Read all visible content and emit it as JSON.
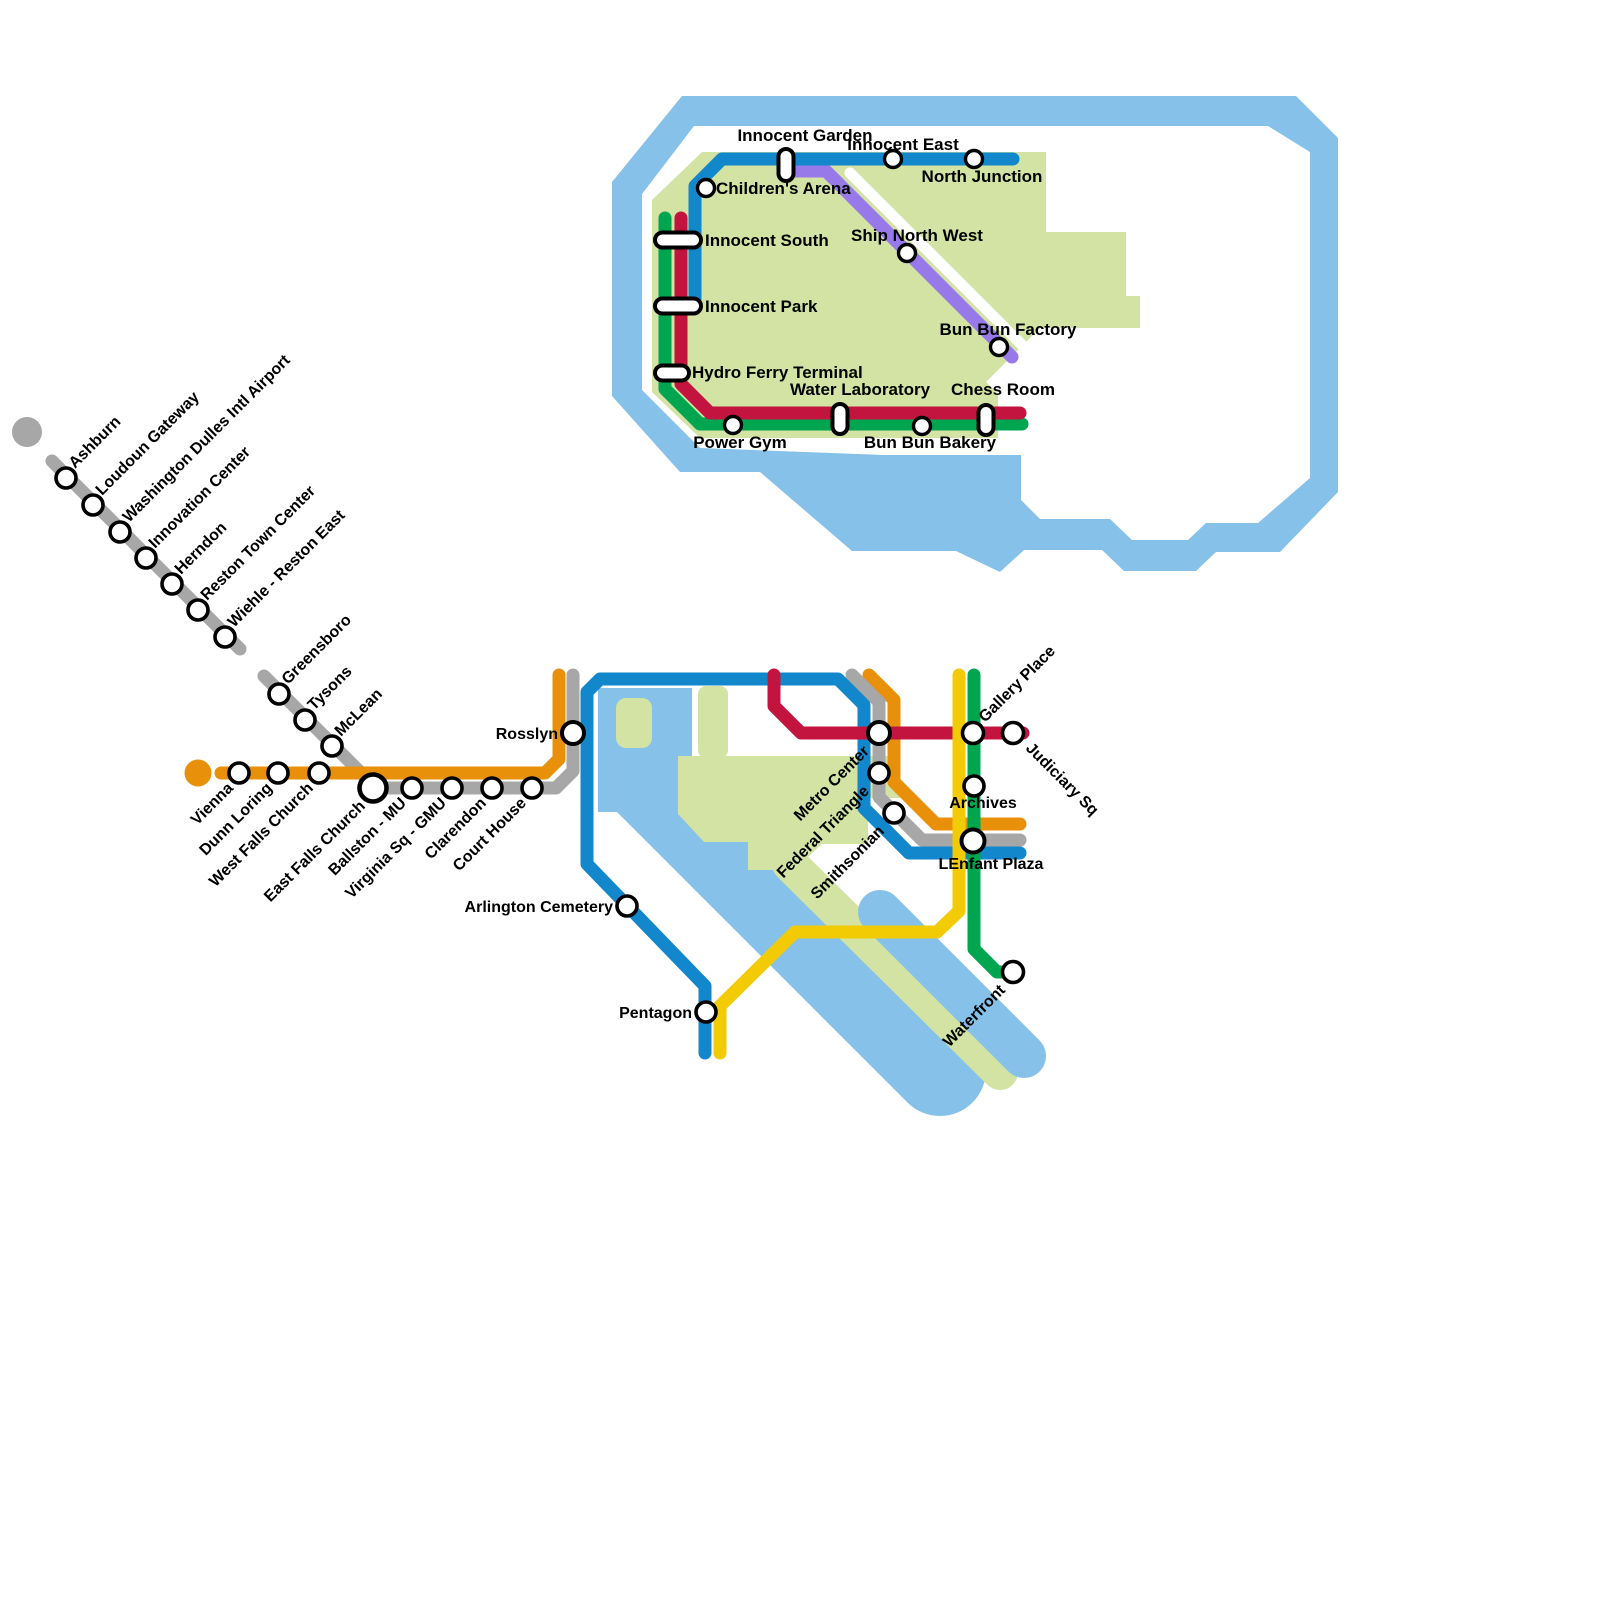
{
  "canvas": {
    "width": 1600,
    "height": 1600
  },
  "palette": {
    "water": "#85C1E8",
    "land": "#D2E3A4",
    "white": "#FFFFFF",
    "blue": "#1287CC",
    "red": "#C31440",
    "green": "#00A550",
    "orange": "#E8900A",
    "silver": "#A7A7A7",
    "yellow": "#F2CB05",
    "purple": "#9879E9",
    "station_fill": "#FFFFFF",
    "station_stroke": "#000000"
  },
  "shapes": [
    {
      "id": "island-water-ring",
      "type": "path",
      "fill": "water",
      "fillRule": "evenodd",
      "d": "M 612,396 L 612,182 L 682,96 L 1296,96 L 1338,138 L 1338,492 L 1280,552 L 1216,552 L 1196,571 L 1124,571 L 1102,550 L 1024,550 L 1000,572 L 956,551 L 852,551 L 760,472 L 680,472 Z M 642,390 L 642,194 L 694,126 L 1268,126 L 1310,152 L 1310,478 L 1258,523 L 1206,523 L 1188,540 L 1132,540 L 1110,519 L 1040,519 L 1021,500 L 1021,455 L 884,455 L 700,448 L 642,390 Z"
    },
    {
      "id": "island-land",
      "type": "path",
      "fill": "land",
      "d": "M 702,152 L 1046,152 L 1046,232 L 1126,232 L 1126,296 L 1140,296 L 1140,328 L 1040,328 L 986,382 L 998,394 L 998,438 L 700,438 L 652,392 L 652,200 Z"
    },
    {
      "id": "island-white-stripe",
      "type": "stroke",
      "color": "white",
      "width": 11,
      "points": [
        [
          850,
          173
        ],
        [
          1036,
          359
        ]
      ]
    },
    {
      "id": "potomac-river-column",
      "type": "path",
      "fill": "water",
      "d": "M 598,688 L 692,688 L 692,812 L 598,812 Z"
    },
    {
      "id": "potomac-river-band",
      "type": "stroke",
      "color": "water",
      "width": 92,
      "points": [
        [
          650,
          780
        ],
        [
          940,
          1070
        ]
      ]
    },
    {
      "id": "roosevelt-island",
      "type": "rect",
      "fill": "land",
      "x": 616,
      "y": 698,
      "w": 36,
      "h": 50,
      "r": 10
    },
    {
      "id": "mall-land-column",
      "type": "rect",
      "fill": "land",
      "x": 698,
      "y": 686,
      "w": 30,
      "h": 72,
      "r": 8
    },
    {
      "id": "mall-land-blob",
      "type": "path",
      "fill": "land",
      "d": "M 678,756 L 900,756 L 900,798 L 868,798 L 868,844 L 822,844 L 794,870 L 748,870 L 748,842 L 704,842 L 678,814 Z"
    },
    {
      "id": "hains-point-strip",
      "type": "stroke",
      "color": "land",
      "width": 36,
      "points": [
        [
          790,
          864
        ],
        [
          1000,
          1072
        ]
      ]
    },
    {
      "id": "anacostia-river-band",
      "type": "stroke",
      "color": "water",
      "width": 44,
      "points": [
        [
          880,
          912
        ],
        [
          1024,
          1056
        ]
      ]
    }
  ],
  "terminal_dots": [
    {
      "id": "silver-line-terminal-dot",
      "x": 27,
      "y": 432,
      "r": 15,
      "color": "silver"
    },
    {
      "id": "orange-line-terminal-dot",
      "x": 198,
      "y": 773,
      "r": 13.5,
      "color": "orange"
    }
  ],
  "lines": [
    {
      "id": "inset-purple-line",
      "color": "purple",
      "width": 13,
      "points": [
        [
          795,
          171
        ],
        [
          826,
          171
        ],
        [
          1012,
          357
        ]
      ]
    },
    {
      "id": "inset-blue-line",
      "color": "blue",
      "width": 13,
      "points": [
        [
          1013,
          159
        ],
        [
          722,
          159
        ],
        [
          695,
          186
        ],
        [
          695,
          307
        ]
      ]
    },
    {
      "id": "inset-green-line",
      "color": "green",
      "width": 13,
      "points": [
        [
          665,
          218
        ],
        [
          665,
          389
        ],
        [
          700,
          424
        ],
        [
          1022,
          424
        ]
      ]
    },
    {
      "id": "inset-red-line",
      "color": "red",
      "width": 13,
      "points": [
        [
          681,
          218
        ],
        [
          681,
          384
        ],
        [
          710,
          413
        ],
        [
          1020,
          413
        ]
      ]
    },
    {
      "id": "silver-line-northwest-branch",
      "color": "silver",
      "width": 13,
      "points": [
        [
          52,
          461
        ],
        [
          240,
          649
        ]
      ]
    },
    {
      "id": "silver-line-tysons-branch",
      "color": "silver",
      "width": 13,
      "points": [
        [
          264,
          676
        ],
        [
          376,
          788
        ],
        [
          556,
          788
        ],
        [
          573,
          771
        ],
        [
          573,
          675
        ]
      ]
    },
    {
      "id": "orange-line-west",
      "color": "orange",
      "width": 13,
      "points": [
        [
          221,
          773
        ],
        [
          545,
          773
        ],
        [
          559,
          759
        ],
        [
          559,
          675
        ]
      ]
    },
    {
      "id": "orange-line-downtown",
      "color": "orange",
      "width": 13,
      "points": [
        [
          869,
          675
        ],
        [
          894,
          700
        ],
        [
          894,
          782
        ],
        [
          936,
          824
        ],
        [
          1020,
          824
        ]
      ]
    },
    {
      "id": "silver-line-downtown",
      "color": "silver",
      "width": 13,
      "points": [
        [
          852,
          675
        ],
        [
          879,
          702
        ],
        [
          879,
          797
        ],
        [
          922,
          840
        ],
        [
          1020,
          840
        ]
      ]
    },
    {
      "id": "blue-line",
      "color": "blue",
      "width": 13,
      "points": [
        [
          705,
          1053
        ],
        [
          705,
          986
        ],
        [
          587,
          864
        ],
        [
          587,
          692
        ],
        [
          600,
          679
        ],
        [
          838,
          679
        ],
        [
          864,
          705
        ],
        [
          864,
          808
        ],
        [
          909,
          853
        ],
        [
          1020,
          853
        ]
      ]
    },
    {
      "id": "red-line",
      "color": "red",
      "width": 13,
      "points": [
        [
          774,
          675
        ],
        [
          774,
          706
        ],
        [
          801,
          733
        ],
        [
          1023,
          733
        ]
      ]
    },
    {
      "id": "yellow-line",
      "color": "yellow",
      "width": 13,
      "points": [
        [
          959,
          675
        ],
        [
          959,
          911
        ],
        [
          937,
          932
        ],
        [
          795,
          932
        ],
        [
          720,
          1006
        ],
        [
          720,
          1053
        ]
      ]
    },
    {
      "id": "green-line",
      "color": "green",
      "width": 13,
      "points": [
        [
          974,
          675
        ],
        [
          974,
          949
        ],
        [
          997,
          972
        ],
        [
          1018,
          972
        ]
      ]
    }
  ],
  "inset_stations": [
    {
      "name": "Innocent Garden",
      "x": 786,
      "y": 165,
      "marker": "pill-v",
      "w": 15,
      "h": 32,
      "label": {
        "dx": 19,
        "dy": -24,
        "anchor": "middle",
        "rot": 0
      }
    },
    {
      "name": "Innocent East",
      "x": 893,
      "y": 159,
      "marker": "circle",
      "r": 8.5,
      "label": {
        "dx": 10,
        "dy": -9,
        "anchor": "middle",
        "rot": 0
      }
    },
    {
      "name": "North Junction",
      "x": 974,
      "y": 159,
      "marker": "circle",
      "r": 8.5,
      "label": {
        "dx": 8,
        "dy": 23,
        "anchor": "middle",
        "rot": 0
      }
    },
    {
      "name": "Children's Arena",
      "x": 706,
      "y": 188,
      "marker": "circle",
      "r": 8.5,
      "label": {
        "dx": 10,
        "dy": 6,
        "anchor": "start",
        "rot": 0
      }
    },
    {
      "name": "Innocent South",
      "x": 678,
      "y": 240,
      "marker": "pill-h",
      "w": 46,
      "h": 15,
      "label": {
        "dx": 27,
        "dy": 6,
        "anchor": "start",
        "rot": 0
      }
    },
    {
      "name": "Innocent Park",
      "x": 678,
      "y": 306,
      "marker": "pill-h",
      "w": 46,
      "h": 15,
      "label": {
        "dx": 27,
        "dy": 6,
        "anchor": "start",
        "rot": 0
      }
    },
    {
      "name": "Hydro Ferry Terminal",
      "x": 672,
      "y": 373,
      "marker": "pill-h",
      "w": 34,
      "h": 15,
      "label": {
        "dx": 20,
        "dy": 5,
        "anchor": "start",
        "rot": 0
      }
    },
    {
      "name": "Ship North West",
      "x": 907,
      "y": 253,
      "marker": "circle",
      "r": 8.5,
      "label": {
        "dx": 10,
        "dy": -12,
        "anchor": "middle",
        "rot": 0
      }
    },
    {
      "name": "Bun Bun Factory",
      "x": 999,
      "y": 347,
      "marker": "circle",
      "r": 8.5,
      "label": {
        "dx": 9,
        "dy": -12,
        "anchor": "middle",
        "rot": 0
      }
    },
    {
      "name": "Water Laboratory",
      "x": 840,
      "y": 419,
      "marker": "pill-v",
      "w": 15,
      "h": 30,
      "label": {
        "dx": 20,
        "dy": -24,
        "anchor": "middle",
        "rot": 0
      }
    },
    {
      "name": "Chess Room",
      "x": 986,
      "y": 420,
      "marker": "pill-v",
      "w": 15,
      "h": 30,
      "label": {
        "dx": 17,
        "dy": -25,
        "anchor": "middle",
        "rot": 0
      }
    },
    {
      "name": "Power Gym",
      "x": 733,
      "y": 425,
      "marker": "circle",
      "r": 8.5,
      "label": {
        "dx": 7,
        "dy": 23,
        "anchor": "middle",
        "rot": 0
      }
    },
    {
      "name": "Bun Bun Bakery",
      "x": 922,
      "y": 426,
      "marker": "circle",
      "r": 8.5,
      "label": {
        "dx": 8,
        "dy": 22,
        "anchor": "middle",
        "rot": 0
      }
    }
  ],
  "main_stations": [
    {
      "name": "Ashburn",
      "x": 66,
      "y": 478,
      "marker": "circle",
      "r": 10,
      "label": {
        "dx": 9,
        "dy": -9,
        "anchor": "start",
        "rot": -45
      }
    },
    {
      "name": "Loudoun Gateway",
      "x": 93,
      "y": 505,
      "marker": "circle",
      "r": 10,
      "label": {
        "dx": 9,
        "dy": -9,
        "anchor": "start",
        "rot": -45
      }
    },
    {
      "name": "Washington Dulles Intl Airport",
      "x": 120,
      "y": 532,
      "marker": "circle",
      "r": 10,
      "label": {
        "dx": 9,
        "dy": -9,
        "anchor": "start",
        "rot": -45
      }
    },
    {
      "name": "Innovation Center",
      "x": 146,
      "y": 558,
      "marker": "circle",
      "r": 10,
      "label": {
        "dx": 9,
        "dy": -9,
        "anchor": "start",
        "rot": -45
      }
    },
    {
      "name": "Herndon",
      "x": 172,
      "y": 584,
      "marker": "circle",
      "r": 10,
      "label": {
        "dx": 9,
        "dy": -9,
        "anchor": "start",
        "rot": -45
      }
    },
    {
      "name": "Reston Town Center",
      "x": 198,
      "y": 610,
      "marker": "circle",
      "r": 10,
      "label": {
        "dx": 9,
        "dy": -9,
        "anchor": "start",
        "rot": -45
      }
    },
    {
      "name": "Wiehle - Reston East",
      "x": 225,
      "y": 637,
      "marker": "circle",
      "r": 10,
      "label": {
        "dx": 9,
        "dy": -9,
        "anchor": "start",
        "rot": -45
      }
    },
    {
      "name": "Greensboro",
      "x": 279,
      "y": 694,
      "marker": "circle",
      "r": 10,
      "label": {
        "dx": 9,
        "dy": -9,
        "anchor": "start",
        "rot": -45
      }
    },
    {
      "name": "Tysons",
      "x": 305,
      "y": 720,
      "marker": "circle",
      "r": 10,
      "label": {
        "dx": 9,
        "dy": -9,
        "anchor": "start",
        "rot": -45
      }
    },
    {
      "name": "McLean",
      "x": 332,
      "y": 746,
      "marker": "circle",
      "r": 10,
      "label": {
        "dx": 9,
        "dy": -9,
        "anchor": "start",
        "rot": -45
      }
    },
    {
      "name": "Vienna",
      "x": 239,
      "y": 773,
      "marker": "circle",
      "r": 10,
      "label": {
        "dx": -5,
        "dy": 16,
        "anchor": "end",
        "rot": -45
      }
    },
    {
      "name": "Dunn Loring",
      "x": 278,
      "y": 773,
      "marker": "circle",
      "r": 10,
      "label": {
        "dx": -5,
        "dy": 16,
        "anchor": "end",
        "rot": -45
      }
    },
    {
      "name": "West Falls Church",
      "x": 319,
      "y": 773,
      "marker": "circle",
      "r": 10,
      "label": {
        "dx": -5,
        "dy": 16,
        "anchor": "end",
        "rot": -45
      }
    },
    {
      "name": "East Falls Church",
      "x": 373,
      "y": 788,
      "marker": "circle",
      "r": 13.5,
      "sw": 4.6,
      "label": {
        "dx": -7,
        "dy": 19,
        "anchor": "end",
        "rot": -45
      }
    },
    {
      "name": "Ballston - MU",
      "x": 412,
      "y": 788,
      "marker": "circle",
      "r": 10,
      "label": {
        "dx": -5,
        "dy": 16,
        "anchor": "end",
        "rot": -45
      }
    },
    {
      "name": "Virginia Sq - GMU",
      "x": 452,
      "y": 788,
      "marker": "circle",
      "r": 10,
      "label": {
        "dx": -5,
        "dy": 16,
        "anchor": "end",
        "rot": -45
      }
    },
    {
      "name": "Clarendon",
      "x": 492,
      "y": 788,
      "marker": "circle",
      "r": 10,
      "label": {
        "dx": -5,
        "dy": 16,
        "anchor": "end",
        "rot": -45
      }
    },
    {
      "name": "Court House",
      "x": 532,
      "y": 788,
      "marker": "circle",
      "r": 10,
      "label": {
        "dx": -5,
        "dy": 16,
        "anchor": "end",
        "rot": -45
      }
    },
    {
      "name": "Rosslyn",
      "x": 573,
      "y": 733,
      "marker": "circle",
      "r": 11,
      "sw": 4,
      "label": {
        "dx": -15,
        "dy": 6,
        "anchor": "end",
        "rot": 0
      }
    },
    {
      "name": "Arlington Cemetery",
      "x": 627,
      "y": 906,
      "marker": "circle",
      "r": 10,
      "label": {
        "dx": -14,
        "dy": 6,
        "anchor": "end",
        "rot": 0
      }
    },
    {
      "name": "Pentagon",
      "x": 706,
      "y": 1012,
      "marker": "circle",
      "r": 10,
      "label": {
        "dx": -14,
        "dy": 6,
        "anchor": "end",
        "rot": 0
      }
    },
    {
      "name": "Metro Center",
      "x": 879,
      "y": 733,
      "marker": "circle",
      "r": 11,
      "sw": 4,
      "label": {
        "dx": -9,
        "dy": 19,
        "anchor": "end",
        "rot": -45
      }
    },
    {
      "name": "Federal Triangle",
      "x": 879,
      "y": 773,
      "marker": "circle",
      "r": 10,
      "label": {
        "dx": -9,
        "dy": 19,
        "anchor": "end",
        "rot": -45
      }
    },
    {
      "name": "Smithsonian",
      "x": 894,
      "y": 813,
      "marker": "circle",
      "r": 10,
      "label": {
        "dx": -9,
        "dy": 19,
        "anchor": "end",
        "rot": -45
      }
    },
    {
      "name": "Archives",
      "x": 974,
      "y": 786,
      "marker": "circle",
      "r": 10,
      "label": {
        "dx": 9,
        "dy": 22,
        "anchor": "middle",
        "rot": 0
      }
    },
    {
      "name": "LEnfant Plaza",
      "x": 973,
      "y": 841,
      "marker": "circle",
      "r": 11.5,
      "sw": 4,
      "label": {
        "dx": 18,
        "dy": 28,
        "anchor": "middle",
        "rot": 0
      }
    },
    {
      "name": "Gallery Place",
      "x": 973,
      "y": 733,
      "marker": "circle",
      "r": 10.5,
      "label": {
        "dx": 12,
        "dy": -10,
        "anchor": "start",
        "rot": -45
      }
    },
    {
      "name": "Judiciary Sq",
      "x": 1013,
      "y": 733,
      "marker": "circle",
      "r": 10.5,
      "label": {
        "dx": 12,
        "dy": 16,
        "anchor": "start",
        "rot": 45
      }
    },
    {
      "name": "Waterfront",
      "x": 1013,
      "y": 972,
      "marker": "circle",
      "r": 10.5,
      "label": {
        "dx": -7,
        "dy": 19,
        "anchor": "end",
        "rot": -45
      }
    }
  ],
  "label_style": {
    "main_size": 16,
    "inset_size": 17
  }
}
